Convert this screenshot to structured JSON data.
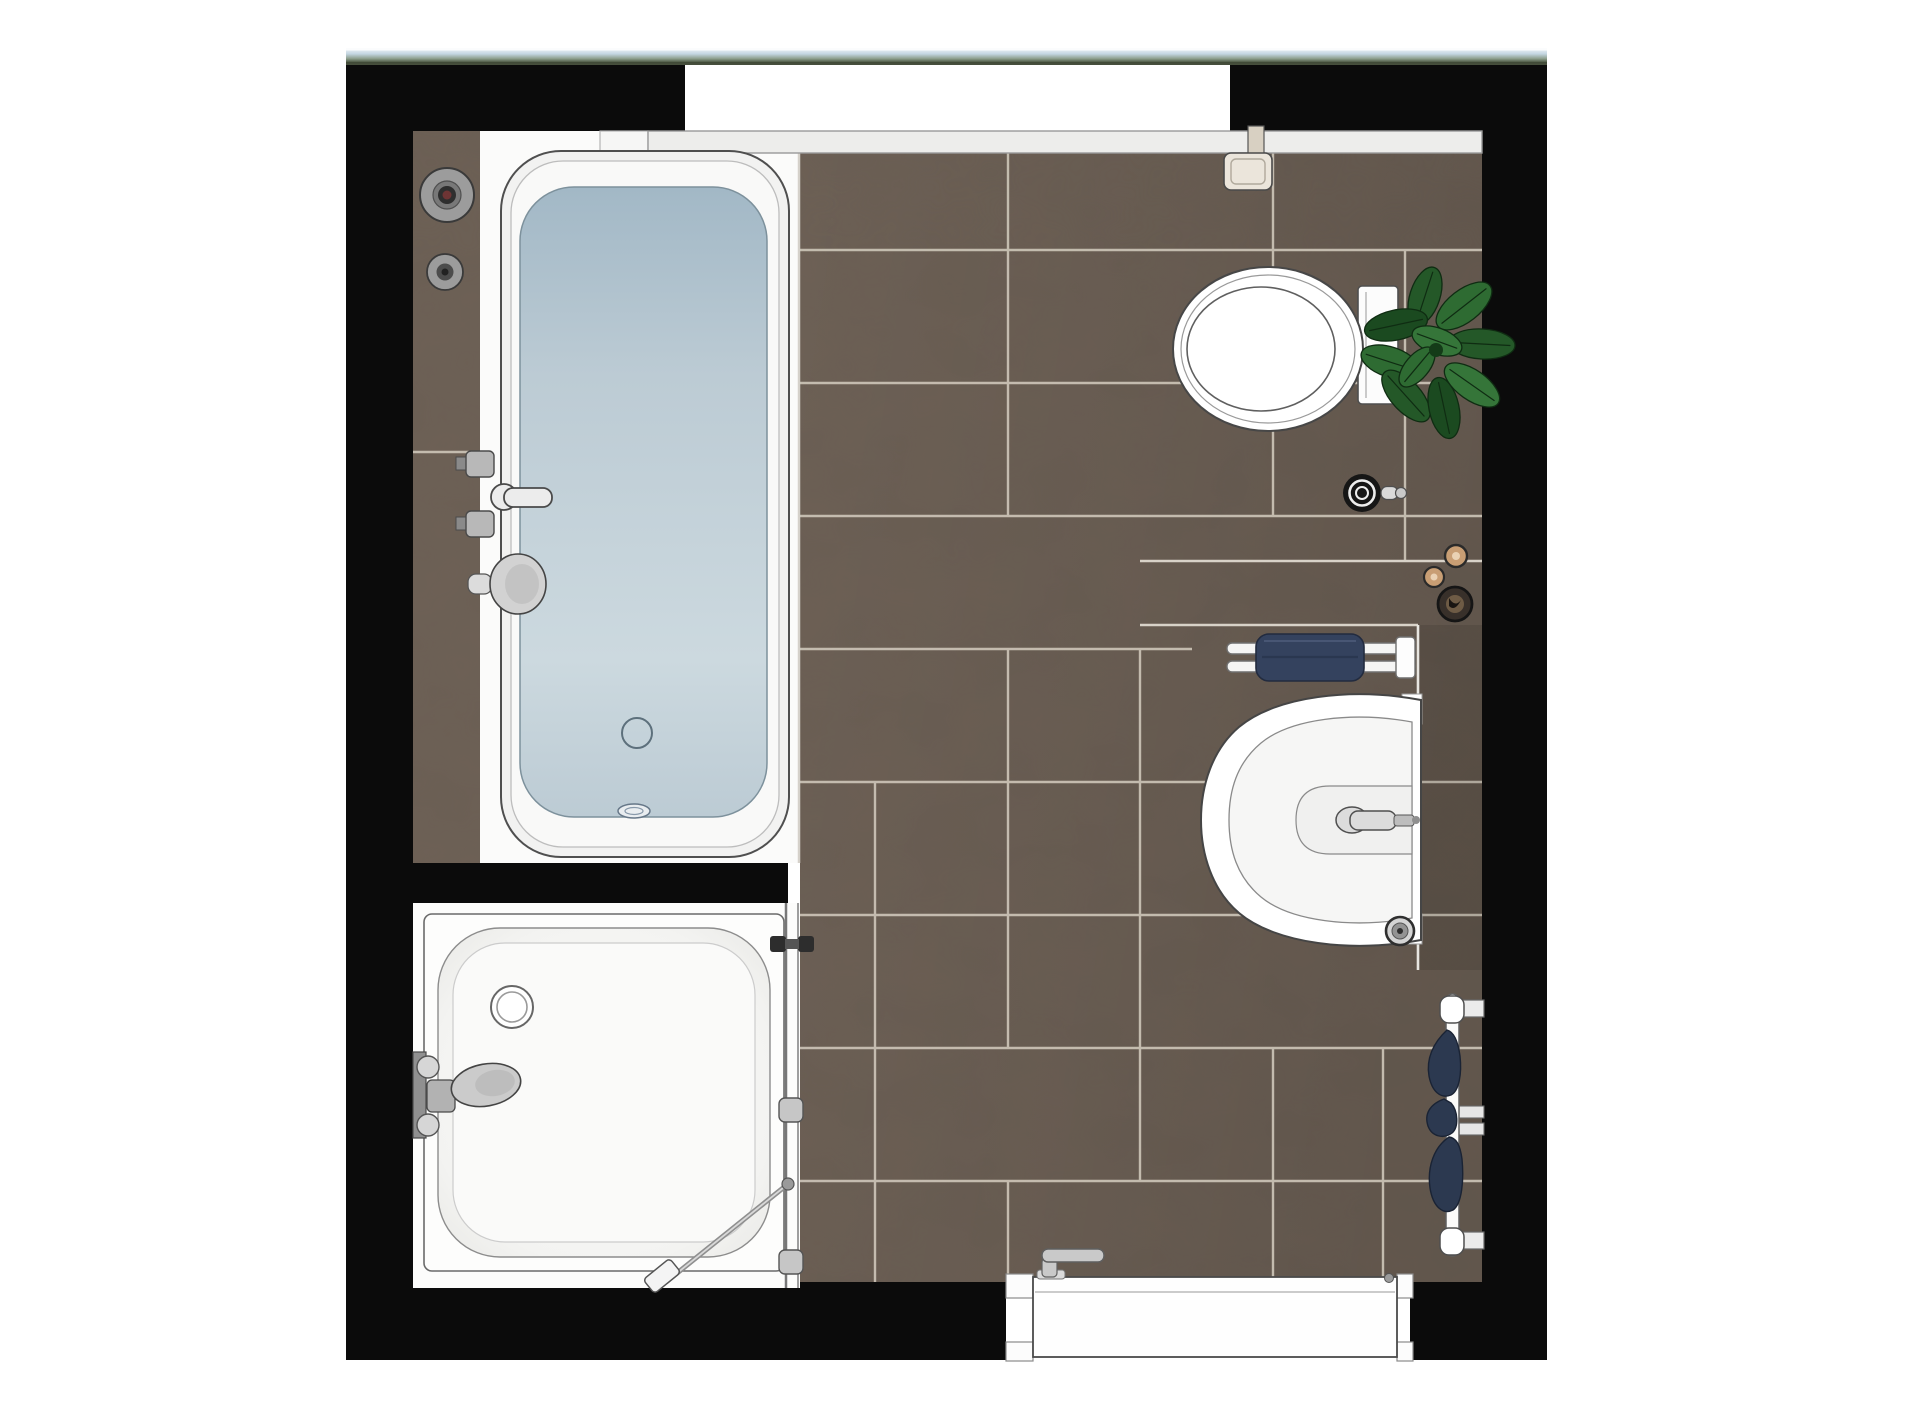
{
  "scene": {
    "title": "Bathroom floor plan — top-down rendering",
    "type": "architectural plan view, no visible text"
  },
  "palette": {
    "wall": "#0b0b0b",
    "floor_tile": "#6e6156",
    "floor_tile_dark": "#5f544b",
    "grout": "#c9c1b4",
    "fixture_white": "#fdfdfd",
    "sill": "#ededeb",
    "water_deep": "#a2b8c6",
    "water_mid": "#bccbd4",
    "water_light": "#ccd9df",
    "towel_navy": "#34425e",
    "towel_navy_dark": "#1c2636",
    "plant_green_a": "#2e6b32",
    "plant_green_b": "#245828",
    "plant_green_c": "#1b4a20",
    "plant_green_d": "#357539",
    "chrome": "#c9c9c9",
    "cream": "#ebe5db",
    "window_sky_light": "#f4f7f9",
    "window_sky": "#c3d5e1",
    "window_horizon": "#8fa08f",
    "window_ground": "#49543f"
  },
  "fixtures": {
    "window_strip": {
      "label": "Window glazing seen from above (top wall)"
    },
    "window_recess": {
      "label": "Window recess opening"
    },
    "window_sill": {
      "label": "Interior window sill ledge"
    },
    "walls": {
      "label": "Black wall outline"
    },
    "floor": {
      "label": "Brown ceramic tile floor"
    },
    "tile_ledge": {
      "label": "Tiled ledge beside bathtub"
    },
    "bathtub": {
      "label": "Bathtub filled with water"
    },
    "bath_drain": {
      "label": "Bathtub drain"
    },
    "bath_overflow": {
      "label": "Bathtub overflow fitting"
    },
    "bath_mixer": {
      "label": "Bath mixer tap with hand shower"
    },
    "wall_controls": {
      "label": "Wall-mounted shower control valves"
    },
    "shower": {
      "label": "Shower enclosure with tray"
    },
    "shower_drain": {
      "label": "Shower drain"
    },
    "shower_mixer": {
      "label": "Shower mixer tap"
    },
    "shower_glass": {
      "label": "Shower glass door with handle and hinges"
    },
    "shower_squeegee": {
      "label": "Shower squeegee resting in corner"
    },
    "toilet": {
      "label": "Toilet, top view with cistern"
    },
    "toilet_brush": {
      "label": "Toilet brush holder"
    },
    "toilet_roll": {
      "label": "Toilet roll holder on wall"
    },
    "plant": {
      "label": "Green potted plant"
    },
    "washbasin": {
      "label": "Washbasin with mixer tap"
    },
    "basin_drain": {
      "label": "Washbasin trap / drain ring"
    },
    "towel_rail": {
      "label": "Towel rail with navy towel above basin"
    },
    "vanity_counter": {
      "label": "Counter ledge beside basin"
    },
    "shelf_items": {
      "label": "Accessories on ledge (jars and candle)"
    },
    "towel_radiator": {
      "label": "Wall towel rack with navy towels"
    },
    "door": {
      "label": "Entrance door with handle"
    }
  }
}
